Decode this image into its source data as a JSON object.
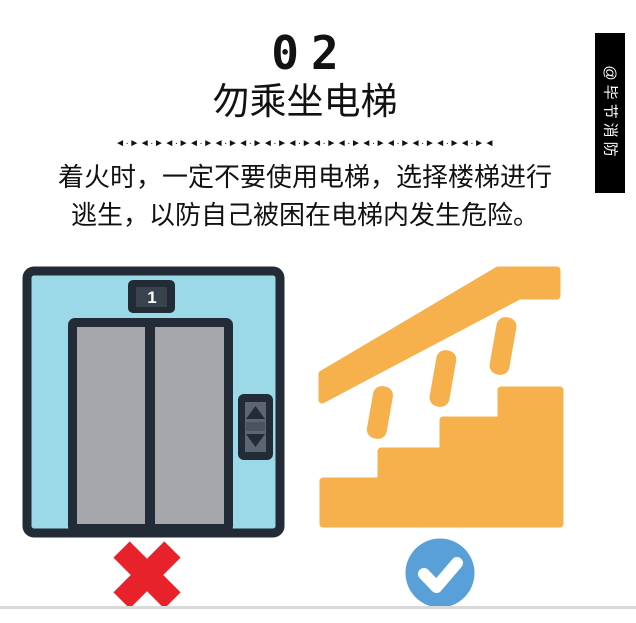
{
  "header": {
    "number": "02",
    "title": "勿乘坐电梯",
    "divider_pattern": "◄·►◄·►◄·►◄·►◄·►◄·►◄·►◄·►◄·►◄·►◄·►◄·►◄·►◄·►◄·►◄"
  },
  "body": {
    "line1": "着火时，一定不要使用电梯，选择楼梯进行",
    "line2": "逃生，以防自己被困在电梯内发生危险。"
  },
  "watermark": {
    "text": "@毕节消防"
  },
  "illustrations": {
    "elevator": {
      "floor_label": "1",
      "verdict_icon": "x-mark-forbidden"
    },
    "stairs": {
      "verdict_icon": "check-mark-allowed"
    }
  },
  "colors": {
    "elevator_wall_blue": "#9BD9E8",
    "elevator_frame_dark": "#232C36",
    "elevator_door_gray": "#A5A7AA",
    "indicator_inner_gray": "#39434E",
    "panel_inner_gray": "#5C6571",
    "panel_mid_gray": "#4A5360",
    "stairs_orange": "#F6B04C",
    "cross_red": "#E7222B",
    "check_blue": "#58A0D7",
    "banner_black": "#000000",
    "text_black": "#121212",
    "bottom_line_gray": "#D9D9D9"
  }
}
